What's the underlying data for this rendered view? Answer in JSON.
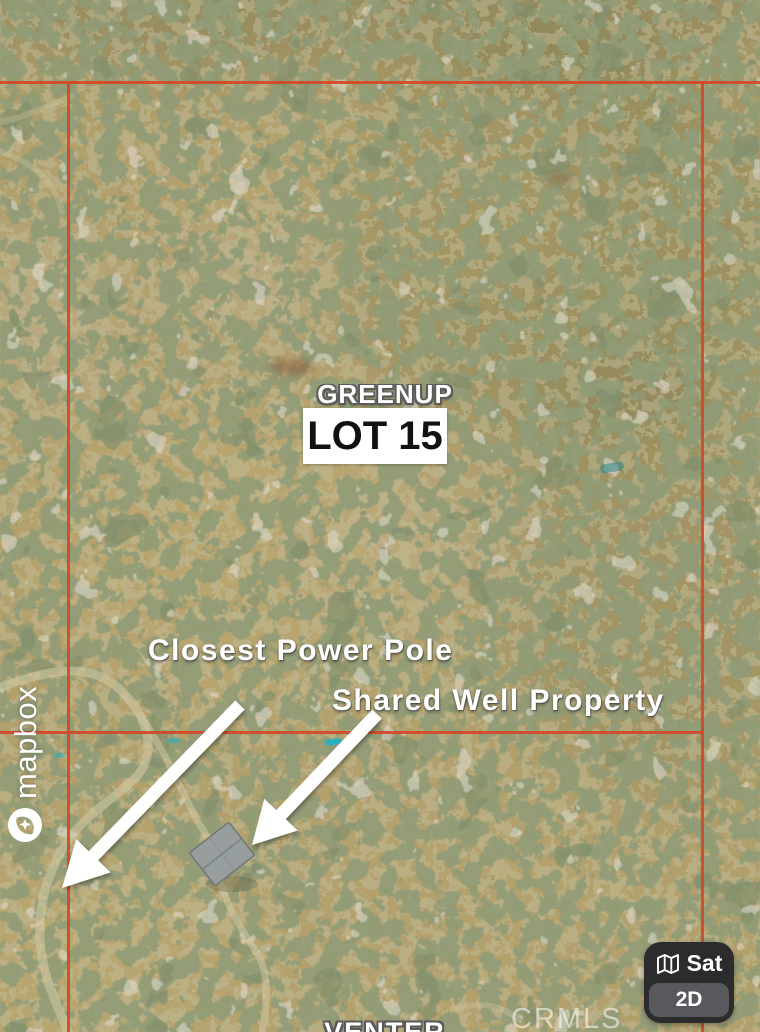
{
  "map": {
    "parcel": {
      "area_name": "GREENUP",
      "lot_label": "LOT 15"
    },
    "annotations": [
      {
        "label": "Closest Power Pole"
      },
      {
        "label": "Shared Well Property"
      }
    ],
    "road_label": "VENTER",
    "watermarks": {
      "provider": "mapbox",
      "mls": "CRMLS"
    },
    "controls": {
      "layer_label": "Sat",
      "view_label": "2D"
    },
    "colors": {
      "boundary_line": "#d2492a",
      "annotation_text": "#ffffff",
      "teal_mark": "#1ab5c4",
      "control_panel_bg": "#2c2c2e",
      "control_button_bg": "#59595d"
    }
  }
}
